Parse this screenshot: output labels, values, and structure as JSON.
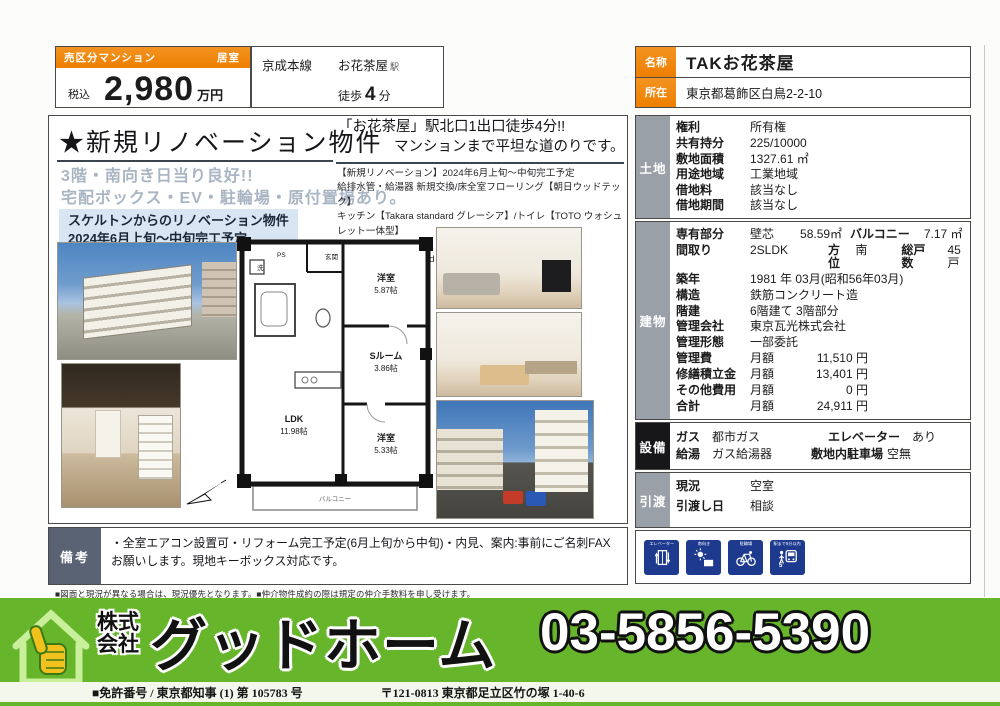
{
  "colors": {
    "accent_orange": "#ee7f00",
    "footer_green": "#67b52b",
    "icon_blue": "#1d3a8f",
    "highlight_blue": "#d8e5f3",
    "label_gray": "#9aa0a8",
    "remarks_slate": "#5a6374"
  },
  "header": {
    "type_badge": "売区分マンション",
    "room_badge": "居室",
    "tax": "税込",
    "price": "2,980",
    "unit": "万円",
    "line": "京成本線",
    "station": "お花茶屋",
    "station_suffix": "駅",
    "walk_label": "徒歩",
    "walk_value": "4",
    "walk_unit": "分",
    "name_label": "名称",
    "name_value": "TAKお花茶屋",
    "addr_label": "所在",
    "addr_value": "東京都葛飾区白鳥2-2-10"
  },
  "main": {
    "title": "★新規リノベーション物件",
    "access1": "「お花茶屋」駅北口1出口徒歩4分!!",
    "access2": "マンションまで平坦な道のりです。",
    "catch1": "3階・南向き日当り良好!!",
    "catch2": "宅配ボックス・EV・駐輪場・原付置場あり。",
    "highlight1": "スケルトンからのリノベーション物件",
    "highlight2": "2024年6月上旬～中旬完工予定",
    "reno": [
      "【新規リノベーション】2024年6月上旬～中旬完工予定",
      "給排水管・給湯器 新規交換/床全室フローリング【朝日ウッドテック】",
      "キッチン【Takara standard グレーシア】/トイレ【TOTO ウォシュレット一体型】",
      "ユニットバス1216size【Housetec】浴室暖房換気乾燥機",
      "洗面【Takara standard リフレシオ】/建具【LIXIL】"
    ]
  },
  "floorplan": {
    "entrance": "玄関",
    "ps": "PS",
    "wash": "洗",
    "room1": "洋室",
    "room1_size": "5.87帖",
    "sroom": "Sルーム",
    "sroom_size": "3.86帖",
    "room2": "洋室",
    "room2_size": "5.33帖",
    "ldk": "LDK",
    "ldk_size": "11.98帖",
    "balcony": "バルコニー"
  },
  "land": {
    "label": "土地",
    "rows": [
      {
        "k": "権利",
        "v": "所有権"
      },
      {
        "k": "共有持分",
        "v": "225/10000"
      },
      {
        "k": "敷地面積",
        "v": "1327.61 ㎡"
      },
      {
        "k": "用途地域",
        "v": "工業地域"
      },
      {
        "k": "借地料",
        "v": "該当なし"
      },
      {
        "k": "借地期間",
        "v": "該当なし"
      }
    ]
  },
  "building": {
    "label": "建物",
    "r1k": "専有部分",
    "r1a": "壁芯",
    "r1b": "58.59㎡",
    "r1c": "バルコニー",
    "r1d": "7.17 ㎡",
    "r2k": "間取り",
    "r2a": "2SLDK",
    "r2b": "方位",
    "r2c": "南",
    "r2d": "総戸数",
    "r2e": "45戸",
    "r3k": "築年",
    "r3v": "1981 年 03月(昭和56年03月)",
    "r4k": "構造",
    "r4v": "鉄筋コンクリート造",
    "r5k": "階建",
    "r5v": "6階建て 3階部分",
    "r6k": "管理会社",
    "r6v": "東京瓦光株式会社",
    "r7k": "管理形態",
    "r7v": "一部委託",
    "monthly": "月額",
    "r8k": "管理費",
    "r8v": "11,510 円",
    "r9k": "修繕積立金",
    "r9v": "13,401 円",
    "r10k": "その他費用",
    "r10v": "0 円",
    "r11k": "合計",
    "r11v": "24,911 円"
  },
  "equip": {
    "label": "設備",
    "gas_k": "ガス",
    "gas_v": "都市ガス",
    "elev_k": "エレベーター",
    "elev_v": "あり",
    "hw_k": "給湯",
    "hw_v": "ガス給湯器",
    "park_k": "敷地内駐車場",
    "park_v": "空無"
  },
  "handover": {
    "label": "引渡",
    "now_k": "現況",
    "now_v": "空室",
    "date_k": "引渡し日",
    "date_v": "相談"
  },
  "features": {
    "f1": "エレベーター",
    "f2": "南向き",
    "f3": "駐輪場",
    "f4": "駅まで5分以内"
  },
  "remarks": {
    "label": "備考",
    "text": "・全室エアコン設置可・リフォーム完工予定(6月上旬から中旬)・内見、案内:事前にご名刺FAXお願いします。現地キーボックス対応です。"
  },
  "fine_print": "■図面と現況が異なる場合は、現況優先となります。■仲介物件成約の際は規定の仲介手数料を申し受けます。",
  "footer": {
    "company_line1": "株式",
    "company_line2": "会社",
    "company_name": "グッドホーム",
    "phone": "03-5856-5390",
    "license": "■免許番号 / 東京都知事 (1) 第 105783 号",
    "address": "〒121-0813 東京都足立区竹の塚 1-40-6"
  }
}
